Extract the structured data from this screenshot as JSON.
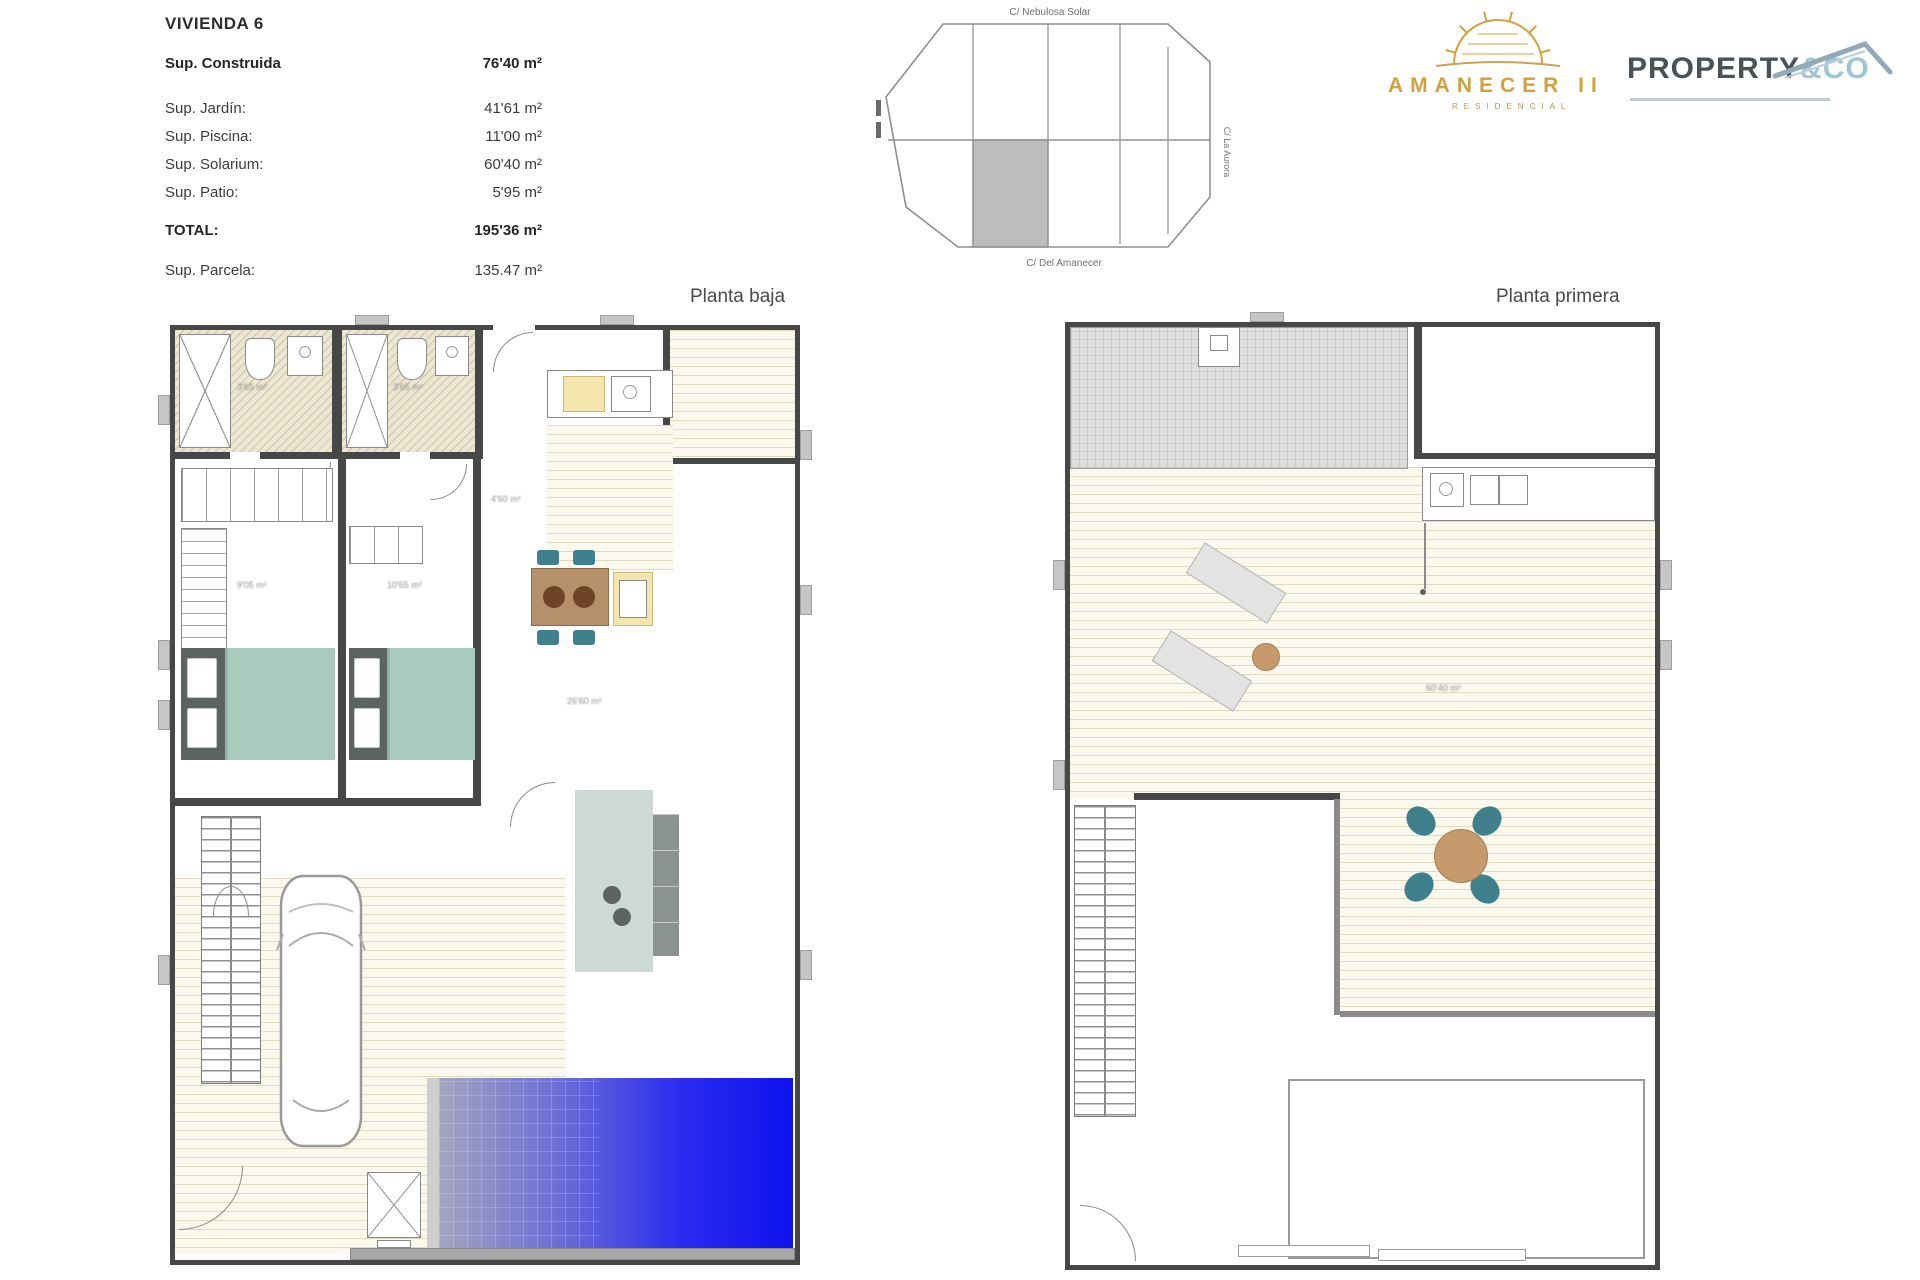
{
  "header": {
    "title": "VIVIENDA 6",
    "rows": [
      {
        "label": "Sup. Construida",
        "value": "76'40 m²"
      },
      {
        "label": "Sup. Jardín:",
        "value": "41'61 m²"
      },
      {
        "label": "Sup. Piscina:",
        "value": "11'00 m²"
      },
      {
        "label": "Sup. Solarium:",
        "value": "60'40 m²"
      },
      {
        "label": "Sup. Patio:",
        "value": "5'95 m²"
      }
    ],
    "total": {
      "label": "TOTAL:",
      "value": "195'36 m²"
    },
    "parcela": {
      "label": "Sup. Parcela:",
      "value": "135.47 m²"
    }
  },
  "site_plan": {
    "street_top": "C/ Nebulosa Solar",
    "street_bottom": "C/ Del Amanecer",
    "street_right": "C/ La Aurora"
  },
  "logos": {
    "amanecer": {
      "title": "AMANECER II",
      "subtitle": "RESIDENCIAL"
    },
    "property": {
      "main": "PROPERTY",
      "accent": "&CO"
    }
  },
  "plans": {
    "baja": {
      "title": "Planta baja",
      "labels": {
        "bath1": "3'65 m²",
        "bath2": "3'65 m²",
        "bed1": "9'05 m²",
        "bed2": "10'65 m²",
        "living": "26'60 m²",
        "hall": "4'60 m²"
      }
    },
    "primera": {
      "title": "Planta primera",
      "labels": {
        "solarium": "60'40 m²"
      }
    }
  },
  "colors": {
    "accent_gold": "#D2A13E",
    "property_blue": "#9FC6D8",
    "pool_blue": "#1418EE",
    "chair_teal": "#3F808C",
    "bed_teal": "#A9CBBD",
    "wall_dark": "#474747"
  }
}
